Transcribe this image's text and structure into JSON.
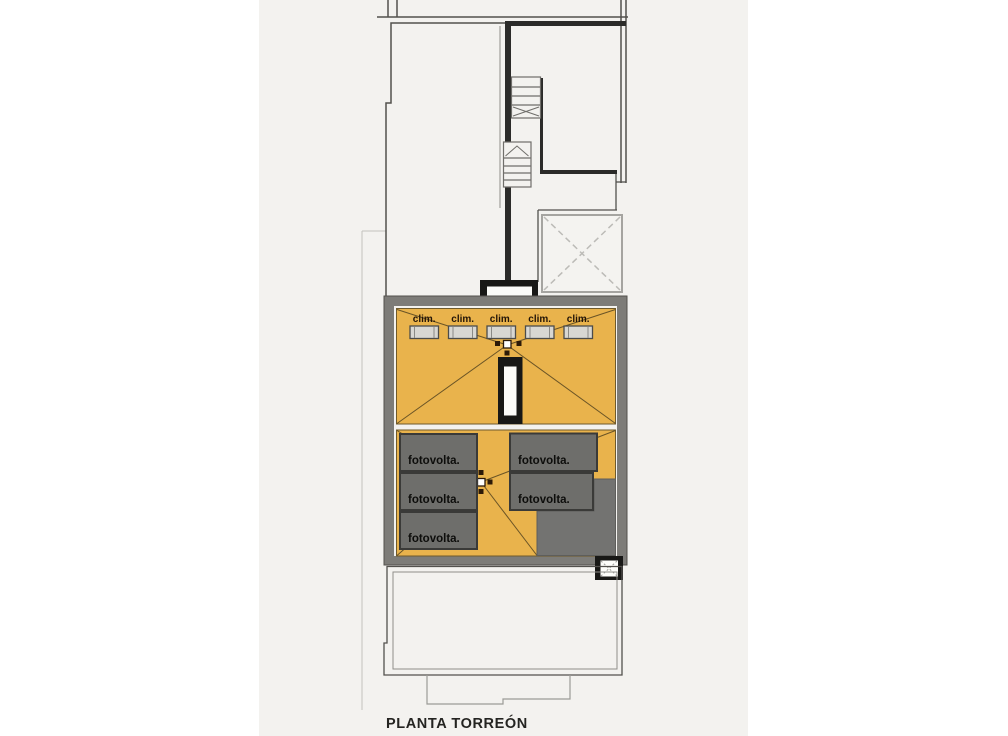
{
  "title": "PLANTA TORREÓN",
  "roof": {
    "clim_units": [
      {
        "label": "clim."
      },
      {
        "label": "clim."
      },
      {
        "label": "clim."
      },
      {
        "label": "clim."
      },
      {
        "label": "clim."
      }
    ],
    "pv_panels": [
      {
        "label": "fotovolta."
      },
      {
        "label": "fotovolta."
      },
      {
        "label": "fotovolta."
      },
      {
        "label": "fotovolta."
      },
      {
        "label": "fotovolta."
      }
    ]
  },
  "colors": {
    "roof_orange": "#e9b34c",
    "frame_gray": "#7d7c78",
    "panel_gray": "#6e6e6b",
    "dark_roof_gray": "#737371",
    "paper": "#f3f2ef",
    "ink": "#181816"
  }
}
